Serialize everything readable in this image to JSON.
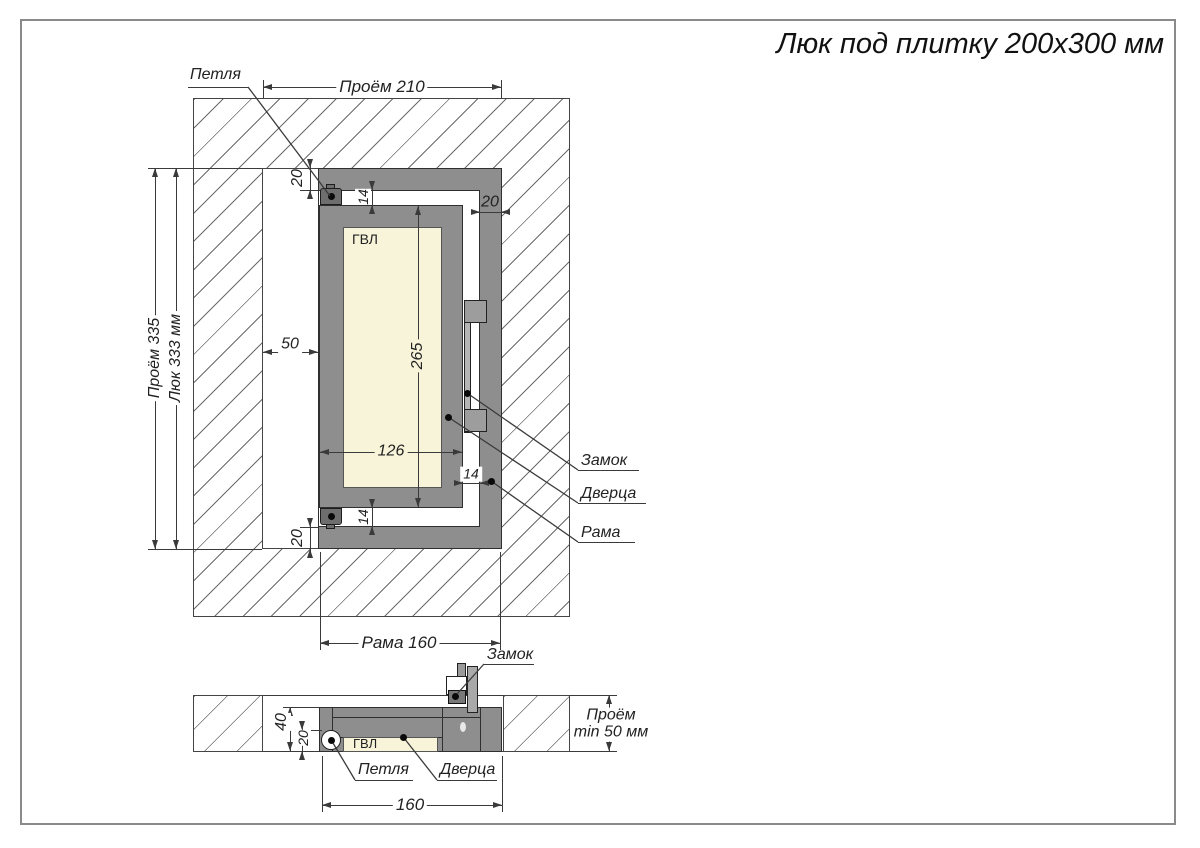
{
  "title": "Люк под плитку 200х300 мм",
  "front_view": {
    "dim_opening_width": "Проём 210",
    "dim_opening_height": "Проём 335",
    "dim_hatch_height": "Люк 333 мм",
    "dim_frame_width": "Рама 160",
    "dim_left_gap": "50",
    "dim_door_width": "126",
    "dim_door_height": "265",
    "dim_top_offset": "20",
    "dim_bottom_offset": "20",
    "dim_top_gap": "14",
    "dim_bottom_gap": "14",
    "dim_right_gap": "14",
    "dim_frame_profile": "20",
    "label_hinge": "Петля",
    "label_lock": "Замок",
    "label_door": "Дверца",
    "label_frame": "Рама",
    "label_panel": "ГВЛ"
  },
  "section_view": {
    "dim_depth_total": "40",
    "dim_door_depth": "20",
    "dim_frame_width": "160",
    "dim_opening_depth_line1": "Проём",
    "dim_opening_depth_line2": "min 50 мм",
    "label_hinge": "Петля",
    "label_lock": "Замок",
    "label_door": "Дверца",
    "label_panel": "ГВЛ"
  }
}
